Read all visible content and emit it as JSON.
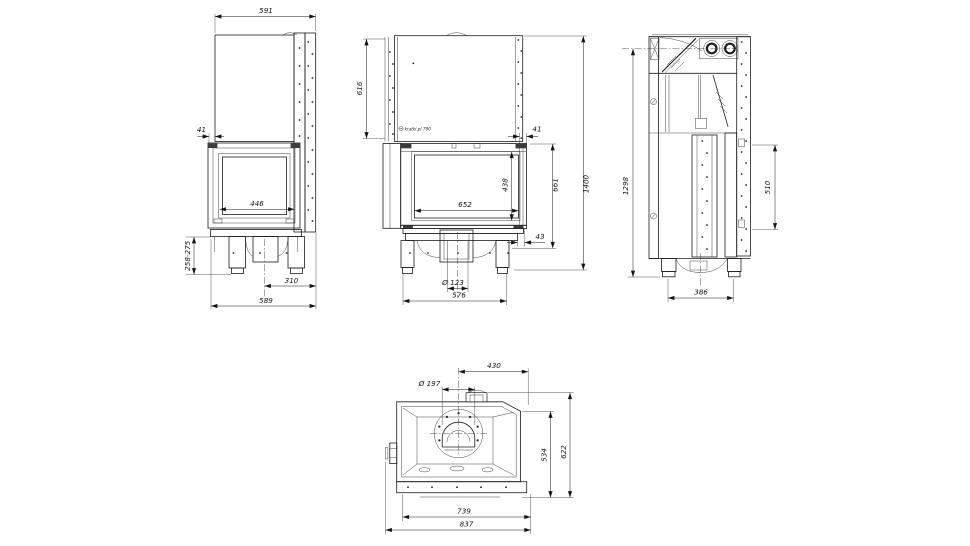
{
  "brand": {
    "logo_text": "kratki.pl 790"
  },
  "views": {
    "left_side": {
      "dims": {
        "top_width": "591",
        "frame_offset": "41",
        "glass_width": "446",
        "leg_height_range": "258-275",
        "leg_spacing": "310",
        "base_width": "589"
      }
    },
    "front": {
      "dims": {
        "hood_height": "616",
        "frame_offset": "41",
        "glass_width": "652",
        "glass_height": "438",
        "door_height": "661",
        "total_height": "1400",
        "base_gap": "43",
        "inlet_diameter": "Ø 123",
        "base_width": "576"
      }
    },
    "right_side": {
      "dims": {
        "body_height": "1298",
        "panel_height": "510",
        "base_depth": "386"
      }
    },
    "top": {
      "dims": {
        "flue_diameter": "Ø 197",
        "flue_center_to_edge": "430",
        "inner_depth": "534",
        "total_depth": "622",
        "body_width": "739",
        "total_width": "837"
      }
    }
  }
}
